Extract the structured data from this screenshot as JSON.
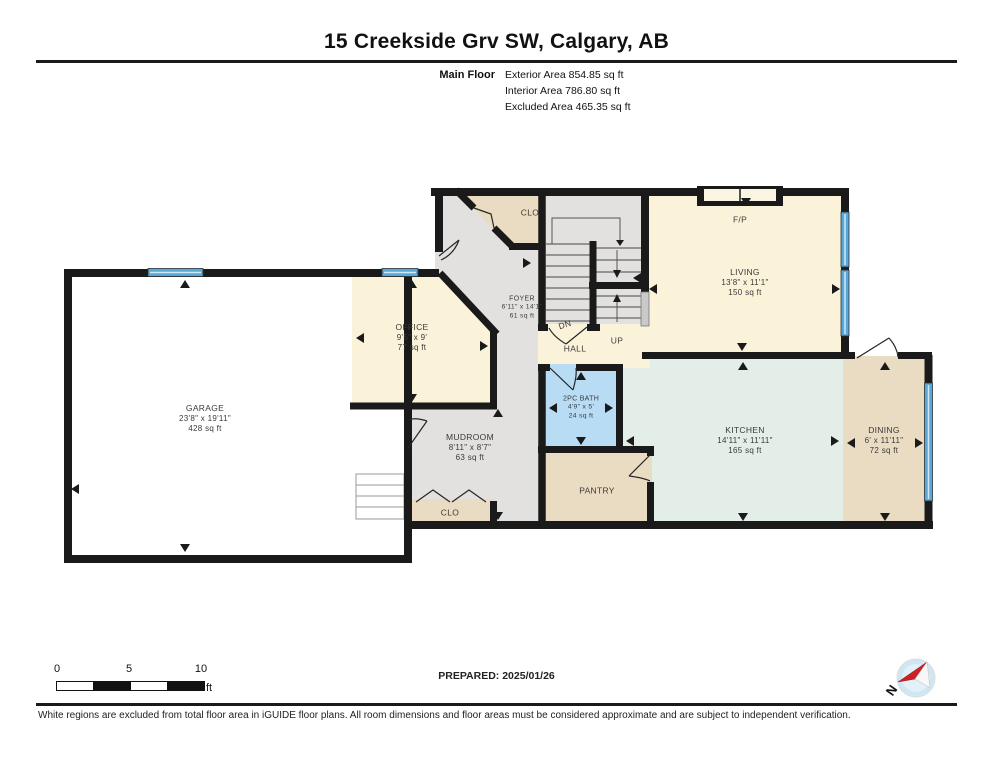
{
  "header": {
    "title": "15 Creekside Grv SW, Calgary, AB",
    "floor_label": "Main Floor",
    "stats": [
      "Exterior Area 854.85 sq ft",
      "Interior Area 786.80 sq ft",
      "Excluded Area 465.35 sq ft"
    ]
  },
  "rooms": {
    "garage": {
      "name": "GARAGE",
      "dims": "23'8\" x 19'11\"",
      "area": "428 sq ft"
    },
    "office": {
      "name": "OFFICE",
      "dims": "9'5\" x 9'",
      "area": "77 sq ft"
    },
    "foyer": {
      "name": "FOYER",
      "dims": "6'11\" x 14'1\"",
      "area": "61 sq ft"
    },
    "closet_top": {
      "name": "CLO"
    },
    "living": {
      "name": "LIVING",
      "dims": "13'8\" x 11'1\"",
      "area": "150 sq ft"
    },
    "fireplace": {
      "name": "F/P"
    },
    "hall": {
      "name": "HALL"
    },
    "stairs_down": {
      "name": "DN"
    },
    "stairs_up": {
      "name": "UP"
    },
    "mudroom": {
      "name": "MUDROOM",
      "dims": "8'11\" x 8'7\"",
      "area": "63 sq ft"
    },
    "closet_bottom": {
      "name": "CLO"
    },
    "bath": {
      "name": "2PC BATH",
      "dims": "4'9\" x 5'",
      "area": "24 sq ft"
    },
    "pantry": {
      "name": "PANTRY"
    },
    "kitchen": {
      "name": "KITCHEN",
      "dims": "14'11\" x 11'11\"",
      "area": "165 sq ft"
    },
    "dining": {
      "name": "DINING",
      "dims": "6' x 11'11\"",
      "area": "72 sq ft"
    }
  },
  "footer": {
    "scale_ticks": [
      "0",
      "5",
      "10"
    ],
    "scale_unit": "ft",
    "prepared": "PREPARED: 2025/01/26",
    "compass_label": "N",
    "disclaimer": "White regions are excluded from total floor area in iGUIDE floor plans. All room dimensions and floor areas must be considered approximate and are subject to independent verification."
  },
  "colors": {
    "wall": "#1a1a1a",
    "room_cream": "#faf3da",
    "room_gray": "#e2e1df",
    "room_tan": "#e9dcc3",
    "room_bath_blue": "#b7dcf4",
    "room_kitchen": "#e2eee7",
    "window_blue": "#58a9d9",
    "excluded_white": "#ffffff",
    "compass_blue": "#cfe7f3",
    "compass_red": "#cc2127"
  }
}
